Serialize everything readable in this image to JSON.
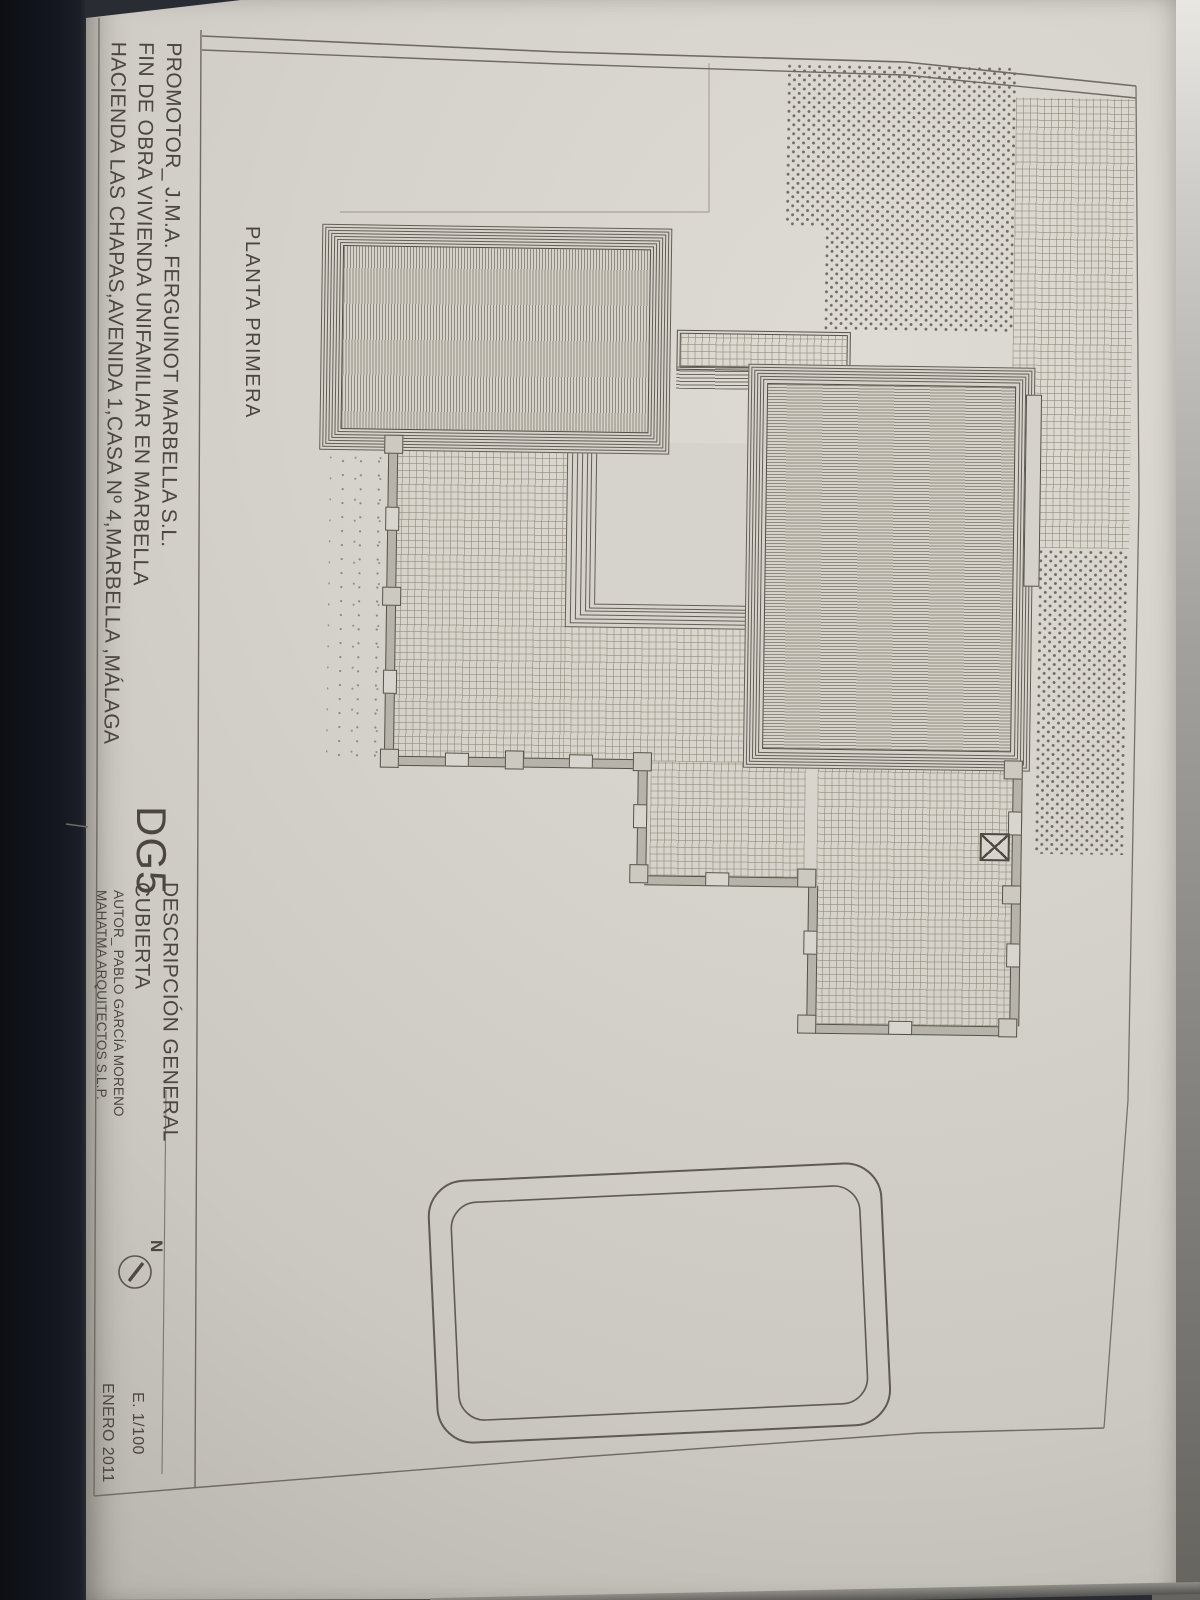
{
  "sheet": {
    "promotor_line1": "PROMOTOR_ J.M.A. FERGUINOT MARBELLA S.L.",
    "promotor_line2": "FIN DE OBRA VIVIENDA UNIFAMILIAR EN MARBELLA",
    "promotor_line3": "HACIENDA LAS CHAPAS,AVENIDA 1,CASA Nº 4,MARBELLA ,MÁLAGA",
    "plan_label": "PLANTA  PRIMERA",
    "sheet_code": "DG5",
    "sheet_title_line1": "DESCRIPCIÓN GENERAL",
    "sheet_title_line2": "CUBIERTA",
    "author_line1": "AUTOR_ PABLO GARCÍA MORENO",
    "author_line2": "MAHATMA ARQUITECTOS S.L.P.",
    "north_label": "N",
    "scale_label": "E. 1/100",
    "date_label": "ENERO 2011"
  },
  "colors": {
    "paper": "#d3d0c9",
    "ink": "#57534b",
    "hatch": "#8f8a7e",
    "grid_line": "#a19a89",
    "stipple_dot": "#6e6a60",
    "photo_background": "#11131a",
    "faint_line": "#a9a497"
  }
}
